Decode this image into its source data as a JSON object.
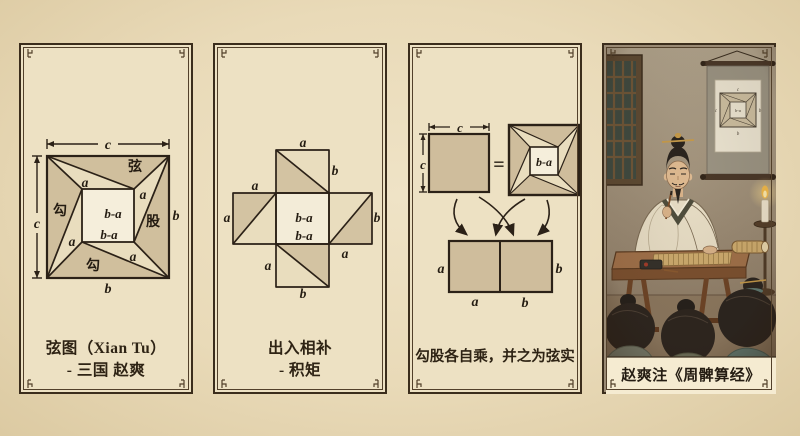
{
  "palette": {
    "background": "#e9dab8",
    "panel_background": "#ede1c3",
    "border": "#3b2d1c",
    "ink": "#2b2117",
    "tan_fill": "#d0bf9d",
    "cream_fill": "#e9ddbe",
    "inner_square_fill": "#f5eedb",
    "caption_band": "#f5ebd1"
  },
  "panel1": {
    "labels": {
      "c_top": "c",
      "c_left": "c",
      "xian": "弦",
      "gou_left": "勾",
      "gu_right": "股",
      "gou_bottom": "勾",
      "a_topleft": "a",
      "a_topright": "a",
      "a_bottomleft": "a",
      "a_bottomright": "a",
      "b_right": "b",
      "b_bottom": "b",
      "ba_center": "b-a",
      "ba_lower": "b-a"
    },
    "caption_line1": "弦图（Xian Tu）",
    "caption_line2": "- 三国 赵爽"
  },
  "panel2": {
    "labels": {
      "a_top": "a",
      "b_topright": "b",
      "a_lefttop": "a",
      "a_leftside": "a",
      "ba_center": "b-a",
      "ba_lower": "b-a",
      "b_right": "b",
      "a_rightbottom": "a",
      "a_bottomleft": "a",
      "b_bottom": "b"
    },
    "caption_line1": "出入相补",
    "caption_line2": "- 积矩"
  },
  "panel3": {
    "labels": {
      "c_top": "c",
      "c_left": "c",
      "equals": "=",
      "ba": "b-a",
      "a_left": "a",
      "b_right": "b",
      "a_bottom": "a",
      "b_bottom": "b"
    },
    "caption": "勾股各自乘，并之为弦实"
  },
  "panel4": {
    "scroll_labels": {
      "c_top": "c",
      "c_left": "c",
      "b_right": "b",
      "b_bottom": "b",
      "ba": "b-a"
    },
    "caption": "赵爽注《周髀算经》"
  }
}
